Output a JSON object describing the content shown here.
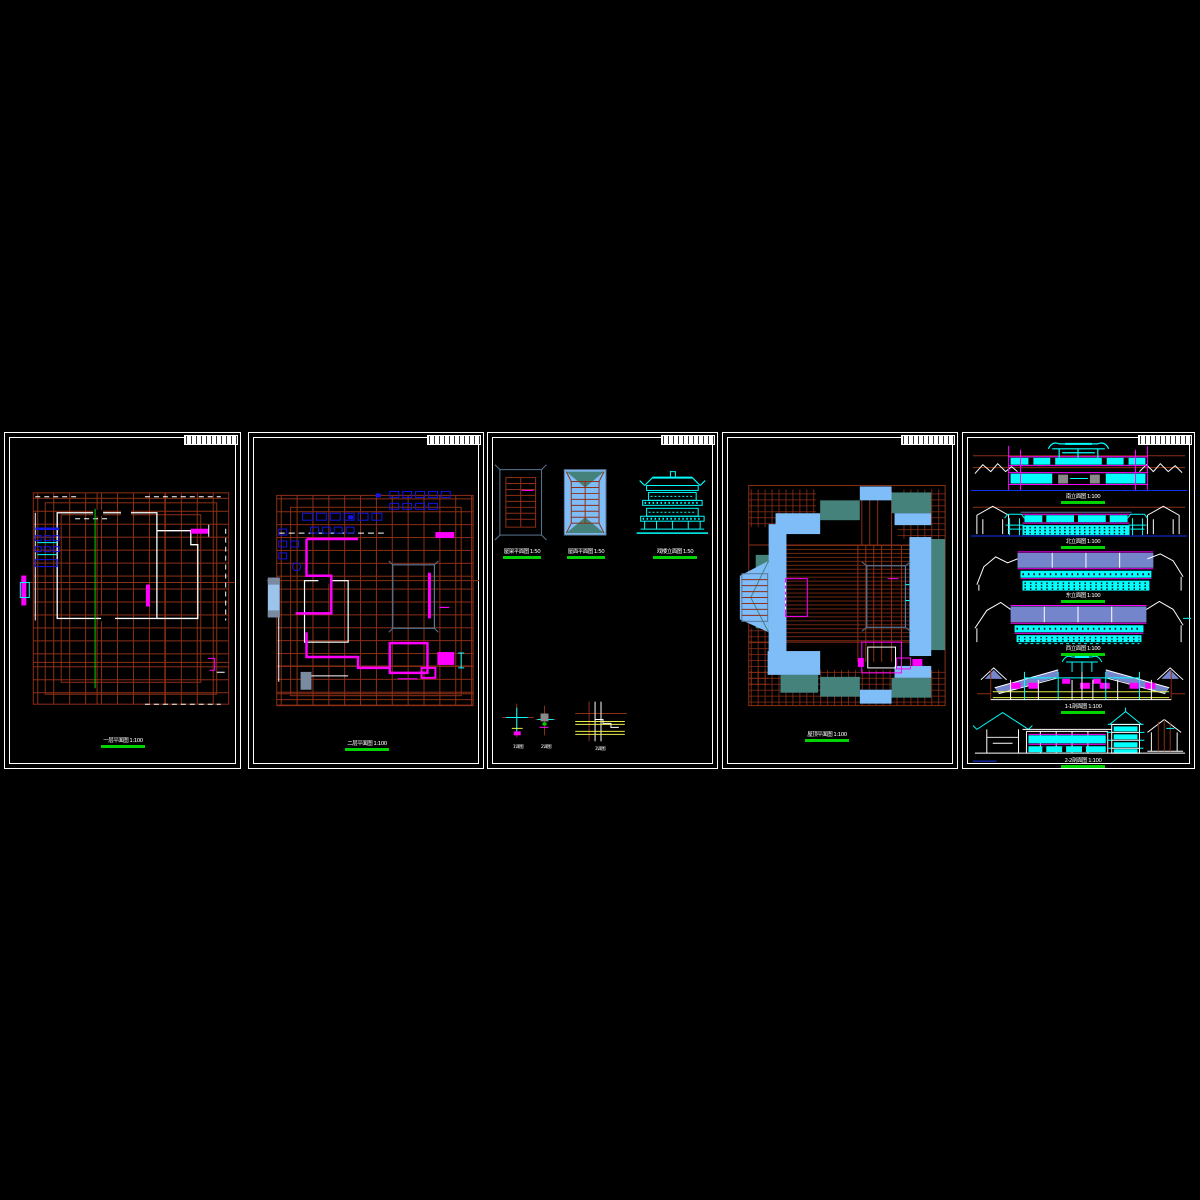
{
  "window": {
    "background": "#000000"
  },
  "palette": {
    "sheet_border": "#ffffff",
    "grid_red": "#8e2f16",
    "wall_white": "#ffffff",
    "axis_green": "#00d400",
    "furniture_blue": "#1414e6",
    "accent_magenta": "#ff00ff",
    "accent_cyan": "#00ffff",
    "roof_sky": "#7fbdf8",
    "roof_teal": "#45827b",
    "court_slate": "#5a7796",
    "roof_periwinkle": "#7585cb",
    "detail_yellow": "#e8ee44",
    "ground_blue": "#1133ee",
    "light_steel": "#9cc3ea",
    "block_slate": "#7a8aa0",
    "gray": "#8a8a8a"
  },
  "sheets": [
    {
      "id": "floor-plan-1",
      "caption": "一层平面图 1:100"
    },
    {
      "id": "floor-plan-2",
      "caption": "二层平面图 1:100"
    },
    {
      "id": "roof-details",
      "captions": [
        "屋架平面图 1:50",
        "屋面平面图 1:50",
        "戏楼立面图 1:50"
      ],
      "detail_labels": [
        "1详图",
        "2详图",
        "3详图"
      ]
    },
    {
      "id": "roof-plan",
      "caption": "屋顶平面图 1:100"
    },
    {
      "id": "elevations",
      "captions": [
        "南立面图 1:100",
        "北立面图 1:100",
        "东立面图 1:100",
        "西立面图 1:100",
        "1-1剖面图 1:100",
        "2-2剖面图 1:100"
      ]
    }
  ]
}
